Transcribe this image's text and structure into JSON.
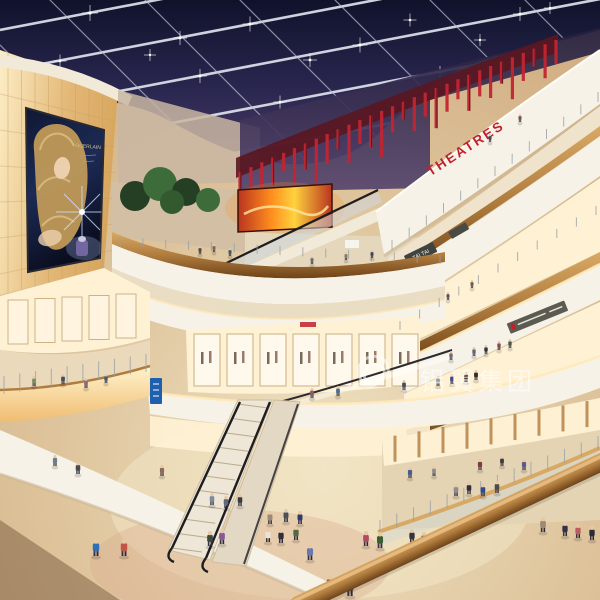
{
  "meta": {
    "title": "Shopping mall atrium interior rendering",
    "width": 600,
    "height": 600
  },
  "labels": {
    "theatre_sign": "THEATRES",
    "store_sign_tai_tai": "TAI TAI",
    "watermark": "铝翼集团",
    "billboard_brand": "GUERLAIN"
  },
  "colors": {
    "sky_top": "#10122b",
    "sky_mid": "#2a2750",
    "sky_low": "#4b3c63",
    "mullion": "#b9bfd0",
    "mullion_bright": "#e3e7f0",
    "wall_light": "#fdeec6",
    "wall_deep": "#e3b776",
    "wall_line": "#caa065",
    "eyebrow": "#f2ead8",
    "billboard_top": "#101832",
    "billboard_mid": "#1c2b56",
    "billboard_dark": "#0a0d1e",
    "hair_gold": "#c9a05a",
    "skin": "#ecd0ae",
    "brand_gold": "#d8c08a",
    "theatre_red": "#c0222c",
    "slat_red": "#c22531",
    "slat_dark": "#5a1620",
    "band_white": "#f7f2e7",
    "band_shade": "#c9b592",
    "cove_glow": "#ffe9b8",
    "wood_light": "#d8a964",
    "wood": "#b07c3e",
    "wood_dark": "#6e4318",
    "store_warm": "#fff1d4",
    "store_floor": "#e9ddc4",
    "glass_tint": "#cfd8e0",
    "rail_dark": "#1d1d22",
    "post_gray": "#9aa0a8",
    "fire_orange": "#ff8c1e",
    "fire_yellow": "#ffd23e",
    "fire_red": "#b8341e",
    "floor_light": "#efe2c2",
    "floor_mid": "#dec49c",
    "floor_warm": "#cfa97e",
    "floor_pink": "#d9a98c",
    "sign_dark": "#3f4440",
    "sign_gray": "#5b5b52",
    "sign_blue": "#1e5fae",
    "tree_green": "#3e6b3a",
    "tree_dark": "#243f24",
    "watermark_white": "#ffffff",
    "shade_brown": "#603e26"
  },
  "ceiling_sparkles": [
    [
      90,
      13,
      1.6
    ],
    [
      180,
      38,
      1.4
    ],
    [
      60,
      61,
      1.3
    ],
    [
      250,
      24,
      1.5
    ],
    [
      40,
      106,
      1.2
    ],
    [
      200,
      76,
      1.4
    ],
    [
      360,
      45,
      1.5
    ],
    [
      520,
      14,
      1.4
    ],
    [
      280,
      102,
      1.3
    ],
    [
      440,
      72,
      1.2
    ],
    [
      330,
      135,
      1.2
    ],
    [
      150,
      55,
      1.2
    ],
    [
      310,
      60,
      1.4
    ],
    [
      410,
      20,
      1.3
    ],
    [
      480,
      40,
      1.2
    ],
    [
      550,
      8,
      1.2
    ]
  ],
  "theatre_slats": [
    34,
    22,
    40,
    28,
    18,
    36,
    26,
    44,
    30,
    20,
    38,
    24,
    32,
    46,
    26,
    18,
    34,
    24,
    40,
    28,
    20,
    36,
    26,
    32,
    22,
    42,
    28,
    18,
    34,
    24
  ],
  "people": [
    [
      96,
      556,
      17,
      "#2f6fb4"
    ],
    [
      124,
      556,
      17,
      "#c05548"
    ],
    [
      210,
      546,
      15,
      "#3c4a3c"
    ],
    [
      222,
      544,
      15,
      "#8a5898"
    ],
    [
      268,
      542,
      14,
      "#e9e3d4"
    ],
    [
      281,
      543,
      14,
      "#30303a"
    ],
    [
      296,
      540,
      14,
      "#4f6a44"
    ],
    [
      310,
      560,
      16,
      "#6a77b0"
    ],
    [
      366,
      546,
      15,
      "#b24a66"
    ],
    [
      380,
      548,
      16,
      "#3c5c34"
    ],
    [
      412,
      543,
      14,
      "#34343e"
    ],
    [
      424,
      546,
      14,
      "#5c4c3c"
    ],
    [
      300,
      524,
      13,
      "#2a3a6a"
    ],
    [
      286,
      522,
      13,
      "#46525c"
    ],
    [
      270,
      524,
      13,
      "#9a8a78"
    ],
    [
      226,
      508,
      12,
      "#5a6a7c"
    ],
    [
      212,
      505,
      12,
      "#7c8c9c"
    ],
    [
      240,
      506,
      12,
      "#3a3a44"
    ],
    [
      162,
      476,
      11,
      "#8a6a58"
    ],
    [
      78,
      474,
      12,
      "#4a4a54"
    ],
    [
      55,
      466,
      11,
      "#6c7c8c"
    ],
    [
      350,
      596,
      18,
      "#444450"
    ],
    [
      330,
      592,
      17,
      "#7a5a4a"
    ],
    [
      456,
      496,
      12,
      "#8c8c94"
    ],
    [
      469,
      494,
      12,
      "#30303a"
    ],
    [
      483,
      496,
      12,
      "#2c4c8c"
    ],
    [
      497,
      493,
      12,
      "#4c4c4c"
    ],
    [
      543,
      532,
      15,
      "#9c8a74"
    ],
    [
      565,
      536,
      14,
      "#32324c"
    ],
    [
      578,
      538,
      14,
      "#bc5c5c"
    ],
    [
      592,
      540,
      14,
      "#2c2c34"
    ],
    [
      524,
      470,
      11,
      "#5c5c8c"
    ],
    [
      410,
      478,
      11,
      "#4c5c8c"
    ],
    [
      480,
      470,
      11,
      "#7c3c3c"
    ],
    [
      502,
      466,
      10,
      "#3c3c3c"
    ],
    [
      434,
      476,
      10,
      "#8c8c8c"
    ],
    [
      404,
      390,
      10,
      "#4c4c54"
    ],
    [
      438,
      386,
      10,
      "#8c9cac"
    ],
    [
      452,
      384,
      10,
      "#3c4c8c"
    ],
    [
      466,
      382,
      10,
      "#54443c"
    ],
    [
      476,
      380,
      10,
      "#2c2c2c"
    ],
    [
      312,
      398,
      10,
      "#8c5c5c"
    ],
    [
      338,
      396,
      10,
      "#4c6c8c"
    ],
    [
      474,
      356,
      9,
      "#5c6c7c"
    ],
    [
      486,
      354,
      9,
      "#32323c"
    ],
    [
      499,
      350,
      9,
      "#8c4c4c"
    ],
    [
      510,
      348,
      9,
      "#4c5c4c"
    ],
    [
      451,
      360,
      9,
      "#6c6c74"
    ],
    [
      312,
      264,
      8,
      "#6c6c78"
    ],
    [
      346,
      260,
      8,
      "#8c7c6c"
    ],
    [
      372,
      258,
      8,
      "#44445c"
    ],
    [
      200,
      254,
      8,
      "#4c4c4c"
    ],
    [
      214,
      252,
      8,
      "#7c6c5c"
    ],
    [
      230,
      256,
      8,
      "#3c5c6c"
    ],
    [
      34,
      386,
      10,
      "#7c8c6c"
    ],
    [
      63,
      384,
      10,
      "#4c4c5c"
    ],
    [
      86,
      388,
      10,
      "#8c6c8c"
    ],
    [
      106,
      383,
      9,
      "#3c5c7c"
    ],
    [
      490,
      142,
      8,
      "#46465c"
    ],
    [
      520,
      122,
      8,
      "#6c5454"
    ],
    [
      448,
      300,
      8,
      "#5c5464"
    ],
    [
      472,
      288,
      8,
      "#705c50"
    ]
  ]
}
